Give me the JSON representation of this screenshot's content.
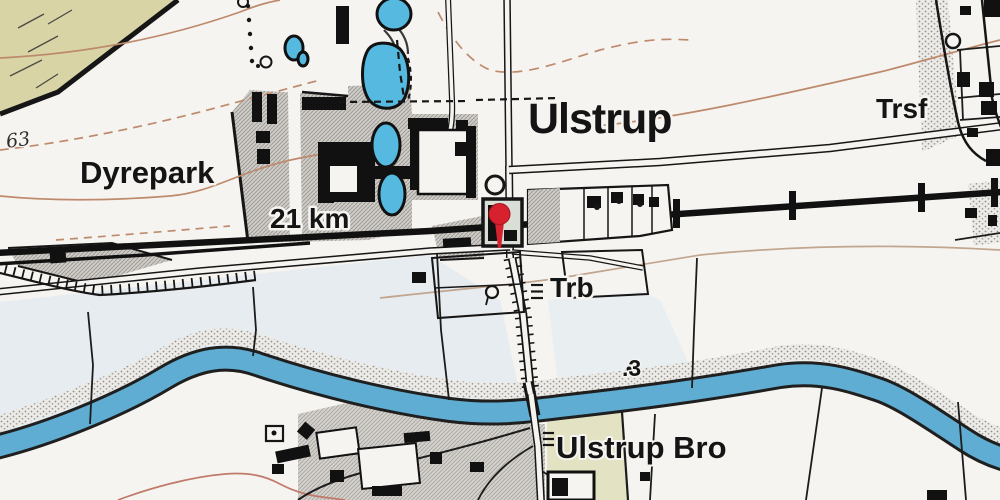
{
  "map": {
    "labels": {
      "town": "Ulstrup",
      "transformer": "Trsf",
      "deer_park": "Dyrepark",
      "distance": "21 km",
      "railway_halt": "Trb",
      "bridge": "Ulstrup Bro",
      "spot_height": "63",
      "elevation_point": ".3"
    },
    "marker": {
      "kind": "map-pin",
      "color": "#D7212E"
    },
    "colors": {
      "paper": "#F6F4F0",
      "river": "#5FADD2",
      "pond": "#55B9E0",
      "forest_khaki": "#D8D4A5",
      "field_khaki": "#E3E2C3",
      "meadow": "#D9E6EF",
      "contour": "#BD8A6D",
      "ink": "#161616"
    }
  }
}
